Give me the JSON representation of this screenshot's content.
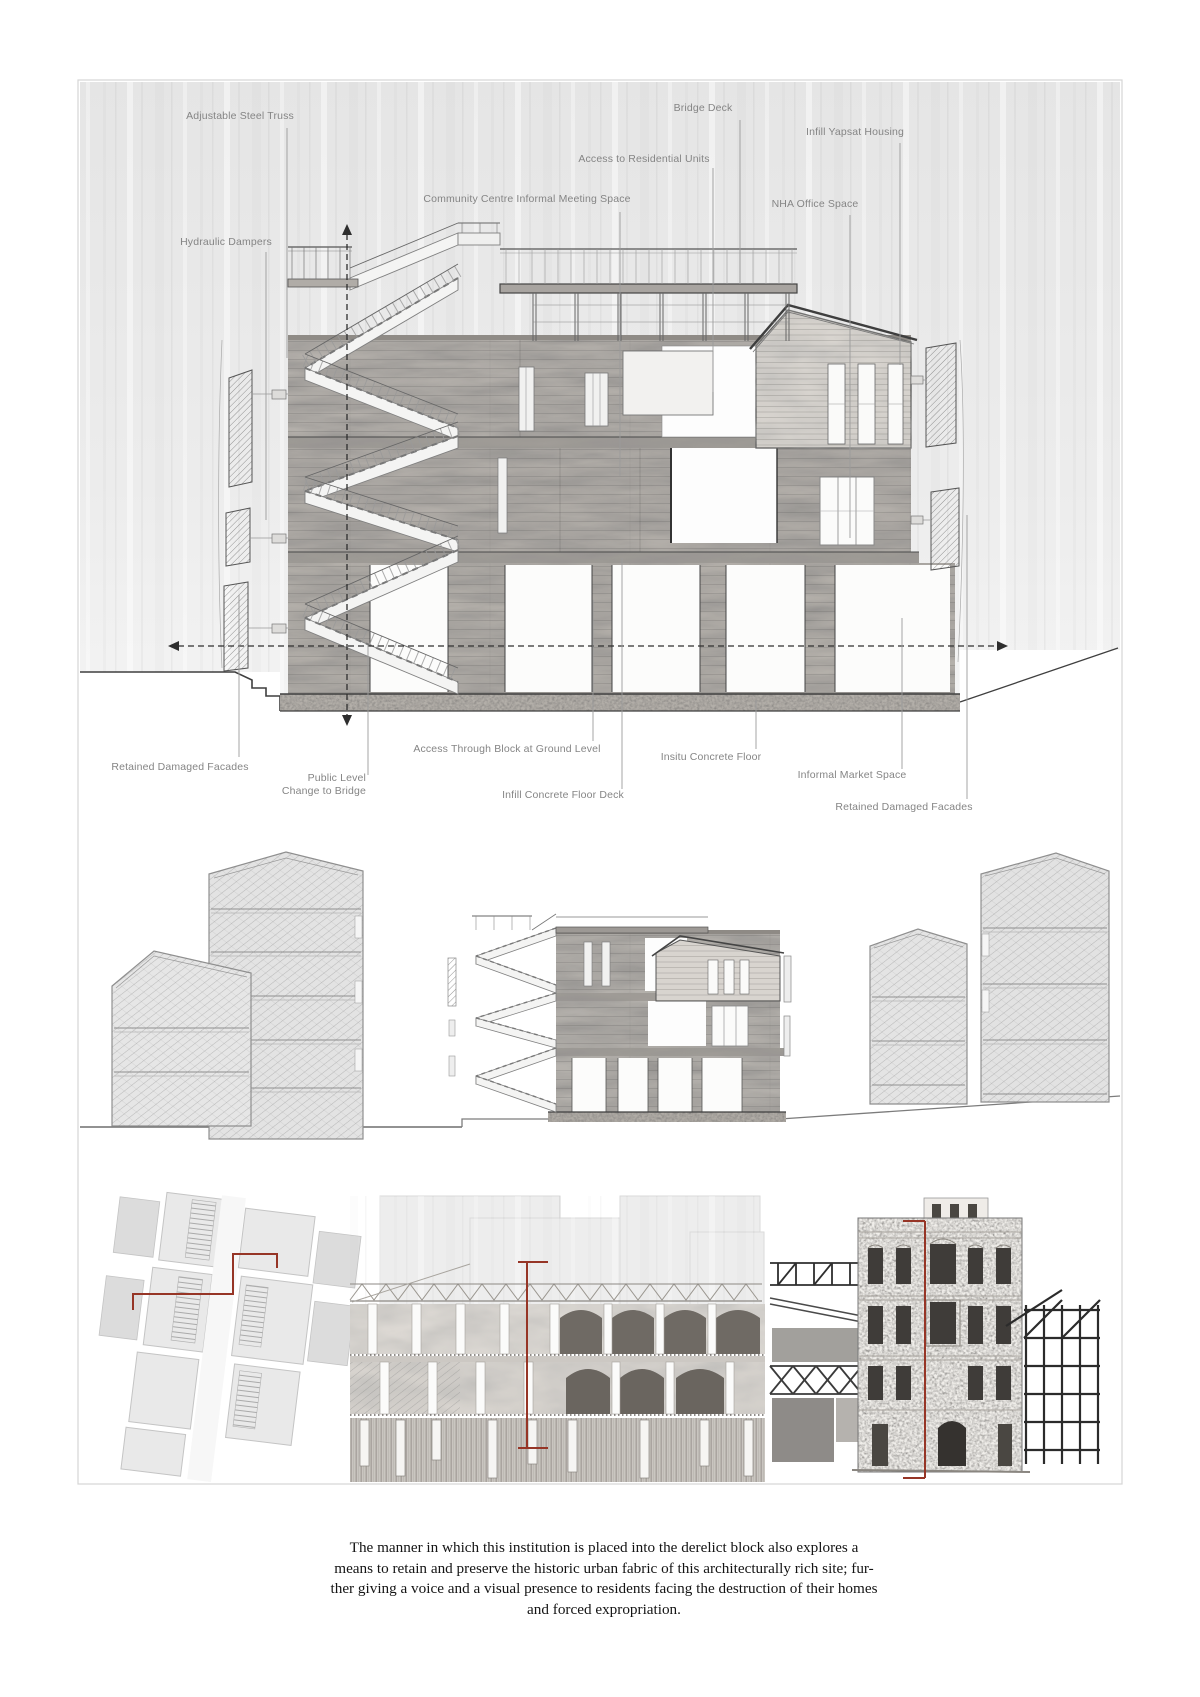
{
  "colors": {
    "accent_red": "#963526",
    "annotation_text": "#858585",
    "drawing_gray": "#b5b1ac",
    "sky_gray": "#ebebeb",
    "caption_text": "#141414"
  },
  "annotations": {
    "adjustable_steel_truss": "Adjustable Steel Truss",
    "bridge_deck": "Bridge Deck",
    "infill_yapsat_housing": "Infill Yapsat Housing",
    "access_residential": "Access to Residential Units",
    "community_centre": "Community Centre Informal Meeting Space",
    "nha_office": "NHA Office Space",
    "hydraulic_dampers": "Hydraulic Dampers",
    "retained_facades_left": "Retained Damaged Facades",
    "public_level": "Public Level\nChange to Bridge",
    "access_through_block": "Access Through Block at Ground Level",
    "infill_floor_deck": "Infill Concrete Floor Deck",
    "insitu_floor": "Insitu Concrete Floor",
    "informal_market": "Informal Market Space",
    "retained_facades_right": "Retained Damaged Facades"
  },
  "caption": {
    "text": "The manner in which this institution is placed into the derelict block also explores a\nmeans to retain and preserve the historic urban fabric of this architecturally rich site; fur-\nther giving a voice and a visual presence to residents facing the destruction of their homes\nand forced expropriation."
  }
}
